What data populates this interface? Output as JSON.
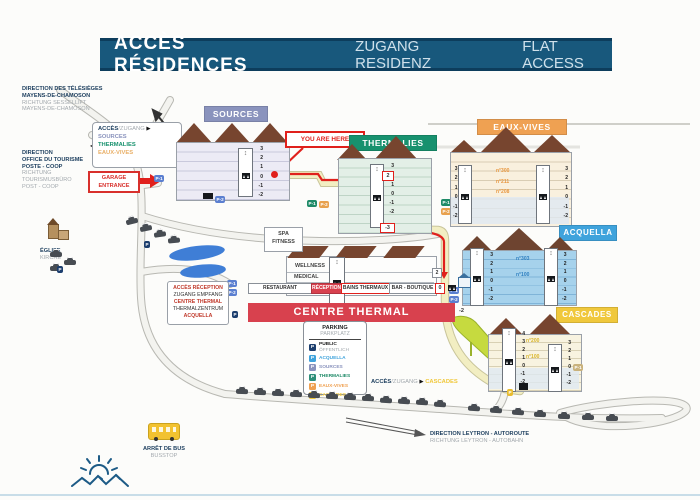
{
  "title_bar": {
    "fr": "ACCÈS RÉSIDENCES",
    "de": "ZUGANG RESIDENZ",
    "en": "FLAT ACCESS"
  },
  "directions": {
    "chairlift_fr": "DIRECTION DES TÉLÉSIÈGES\nMAYENS-DE-CHAMOSON",
    "chairlift_de": "RICHTUNG SESSELLIFT\nMAYENS-DE-CHAMOSON",
    "tourism_fr": "DIRECTION\nOFFICE DU TOURISME\nPOSTE - COOP",
    "tourism_de": "RICHTUNG\nTOURISMUSBÜRO\nPOST - COOP",
    "leytron_fr": "DIRECTION LEYTRON - AUTOROUTE",
    "leytron_de": "RICHTUNG LEYTRON - AUTOBAHN"
  },
  "access_top": {
    "fr": "ACCÈS",
    "de": "/ZUGANG",
    "arrow": "▶",
    "items": [
      "SOURCES",
      "THERMALIES",
      "EAUX-VIVES"
    ]
  },
  "access_cascades": {
    "fr": "ACCÈS",
    "de": "/ZUGANG",
    "arrow": "▶",
    "target": "CASCADES"
  },
  "garage_box": "GARAGE\nENTRANCE",
  "you_are_here": "YOU ARE HERE",
  "church": {
    "fr": "ÉGLISE",
    "de": "KIRCHE"
  },
  "bus": {
    "fr": "ARRÊT DE BUS",
    "de": "BUSSTOP"
  },
  "info_box": {
    "line1": "ACCÈS RÉCEPTION",
    "line2": "ZUGANG EMPFANG",
    "line3": "CENTRE THERMAL",
    "line4": "THERMALZENTRUM",
    "line5": "ACQUELLA"
  },
  "buildings": {
    "sources": {
      "name": "SOURCES",
      "floors": "3\n2\n1\n0\n-1\n-2"
    },
    "thermalies": {
      "name": "THERMALIES",
      "floors": "3\n2\n1\n0\n-1\n-2",
      "entry_level": "2",
      "lower_level": "-3"
    },
    "eaux_vives": {
      "name": "EAUX-VIVES",
      "floors_left": "3\n2\n1\n0\n-1\n-2",
      "floors_right": "3\n2\n1\n0\n-1\n-2",
      "units": "n°300\nn°211\nn°208"
    },
    "acquella": {
      "name": "ACQUELLA",
      "floors_left": "3\n2\n1\n0\n-1\n-2",
      "floors_right": "3\n2\n1\n0\n-1\n-2",
      "unit_upper": "n°303",
      "unit_lower": "n°100"
    },
    "cascades": {
      "name": "CASCADES",
      "floors_left": "4\n3\n2\n1\n0\n-1\n-2",
      "floors_right": "3\n2\n1\n0\n-1\n-2",
      "unit_upper": "n°200",
      "unit_lower": "n°100"
    }
  },
  "centre_thermal": {
    "banner": "CENTRE THERMAL",
    "banner_level": "-2",
    "spa": "SPA\nFITNESS",
    "wellness": "WELLNESS",
    "medical": "MEDICAL",
    "restaurant": "RESTAURANT",
    "reception": "RÉCEPTION",
    "baths": "BAINS THERMAUX",
    "bar": "BAR - BOUTIQUE",
    "bar_level": "0",
    "walkway_level": "2"
  },
  "parking_legend": {
    "title_fr": "PARKING",
    "title_de": "PARKPLATZ",
    "badge": "P",
    "items": [
      {
        "label": "PUBLIC",
        "label2": "ÖFFENTLICH"
      },
      {
        "label": "ACQUELLA"
      },
      {
        "label": "SOURCES"
      },
      {
        "label": "THERMALIES"
      },
      {
        "label": "EAUX-VIVES"
      },
      {
        "label": "CASCADES"
      }
    ]
  },
  "badges": {
    "p": "P",
    "p_minus1": "P-1",
    "p_minus2": "P-2"
  },
  "icons": {
    "shaft_arrows": "↕",
    "arrow_right": "▶"
  },
  "colors": {
    "title_bar_bg": "#18587c",
    "accent_red": "#e0201c",
    "banner_red": "#d8414e",
    "sources": "#8a93bd",
    "thermalies": "#17916e",
    "eaux_vives": "#efa152",
    "acquella": "#3fa3dc",
    "cascades": "#f0c83c",
    "parking_public": "#1c3e6e",
    "road_yellow": "#f2eec2",
    "water": "#3f7ed6"
  }
}
